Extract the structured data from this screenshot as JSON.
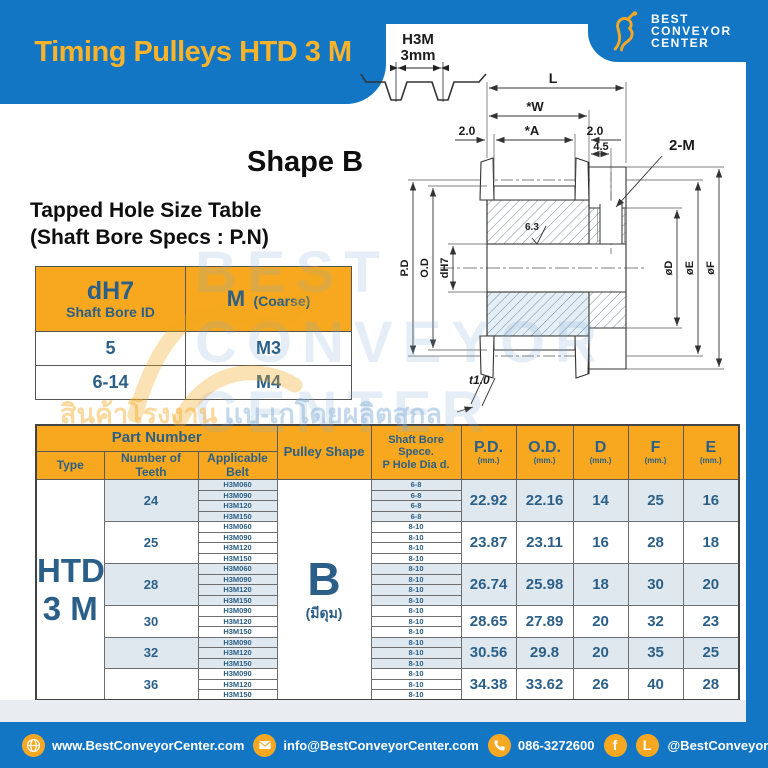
{
  "page_title": "Timing Pulleys HTD 3 M",
  "brand": {
    "line1": "BEST",
    "line2": "CONVEYOR",
    "line3": "CENTER"
  },
  "profile": {
    "name": "H3M",
    "pitch": "3mm"
  },
  "shape_heading": "Shape B",
  "tapped_table": {
    "title1": "Tapped Hole Size Table",
    "title2": "(Shaft Bore Specs : P.N)",
    "col1_main": "dH7",
    "col1_sub": "Shaft Bore ID",
    "col2_main": "M",
    "col2_sub": "(Coarse)",
    "rows": [
      {
        "bore": "5",
        "thread": "M3"
      },
      {
        "bore": "6-14",
        "thread": "M4"
      }
    ]
  },
  "drawing": {
    "dims": {
      "length": "L",
      "width": "*W",
      "a": "*A",
      "left_offset": "2.0",
      "right_offset": "2.0",
      "hole_offset": "4.5",
      "tapped_hole": "2-M",
      "pitch_dia": "P.D",
      "outer_dia": "O.D",
      "bore": "dH7",
      "surface": "6.3",
      "dia_d": "øD",
      "dia_e": "øE",
      "dia_f": "øF",
      "flange_t": "t1.0"
    }
  },
  "main_table": {
    "header": {
      "part_number": "Part Number",
      "type": "Type",
      "teeth": "Number of Teeth",
      "belt": "Applicable Belt",
      "shape": "Pulley Shape",
      "bore1": "Shaft Bore Spece.",
      "bore2": "P Hole Dia d.",
      "cols": [
        {
          "main": "P.D.",
          "unit": "(mm.)"
        },
        {
          "main": "O.D.",
          "unit": "(mm.)"
        },
        {
          "main": "D",
          "unit": "(mm.)"
        },
        {
          "main": "F",
          "unit": "(mm.)"
        },
        {
          "main": "E",
          "unit": "(mm.)"
        }
      ]
    },
    "type_line1": "HTD",
    "type_line2": "3 M",
    "shape_value": "B",
    "shape_note": "(มีดุม)",
    "groups": [
      {
        "teeth": "24",
        "shaded": true,
        "belts": [
          "H3M060",
          "H3M090",
          "H3M120",
          "H3M150"
        ],
        "bores": [
          "6-8",
          "6-8",
          "6-8",
          "6-8"
        ],
        "pd": "22.92",
        "od": "22.16",
        "d": "14",
        "f": "25",
        "e": "16"
      },
      {
        "teeth": "25",
        "shaded": false,
        "belts": [
          "H3M060",
          "H3M090",
          "H3M120",
          "H3M150"
        ],
        "bores": [
          "8-10",
          "8-10",
          "8-10",
          "8-10"
        ],
        "pd": "23.87",
        "od": "23.11",
        "d": "16",
        "f": "28",
        "e": "18"
      },
      {
        "teeth": "28",
        "shaded": true,
        "belts": [
          "H3M060",
          "H3M090",
          "H3M120",
          "H3M150"
        ],
        "bores": [
          "8-10",
          "8-10",
          "8-10",
          "8-10"
        ],
        "pd": "26.74",
        "od": "25.98",
        "d": "18",
        "f": "30",
        "e": "20"
      },
      {
        "teeth": "30",
        "shaded": false,
        "belts": [
          "H3M090",
          "H3M120",
          "H3M150"
        ],
        "bores": [
          "8-10",
          "8-10",
          "8-10"
        ],
        "pd": "28.65",
        "od": "27.89",
        "d": "20",
        "f": "32",
        "e": "23"
      },
      {
        "teeth": "32",
        "shaded": true,
        "belts": [
          "H3M090",
          "H3M120",
          "H3M150"
        ],
        "bores": [
          "8-10",
          "8-10",
          "8-10"
        ],
        "pd": "30.56",
        "od": "29.8",
        "d": "20",
        "f": "35",
        "e": "25"
      },
      {
        "teeth": "36",
        "shaded": false,
        "belts": [
          "H3M090",
          "H3M120",
          "H3M150"
        ],
        "bores": [
          "8-10",
          "8-10",
          "8-10"
        ],
        "pd": "34.38",
        "od": "33.62",
        "d": "26",
        "f": "40",
        "e": "28"
      }
    ]
  },
  "watermark": {
    "line1": "BEST",
    "line2": "CONVEYOR",
    "line3": "CENTER",
    "thai_left": "สินค้าโรงงาน",
    "thai_right": "เเบ-เกโดยผลิตสุกล"
  },
  "footer": {
    "website": "www.BestConveyorCenter.com",
    "email": "info@BestConveyorCenter.com",
    "phone": "086-3272600",
    "social": "@BestConveyorCenter"
  },
  "colors": {
    "blue": "#1276C5",
    "yellow": "#F7A823",
    "banner_text": "#F9B32A",
    "dark_blue_text": "#2B5F88",
    "row_shade": "#DFE8EF",
    "header_fill": "#F7A81E"
  }
}
